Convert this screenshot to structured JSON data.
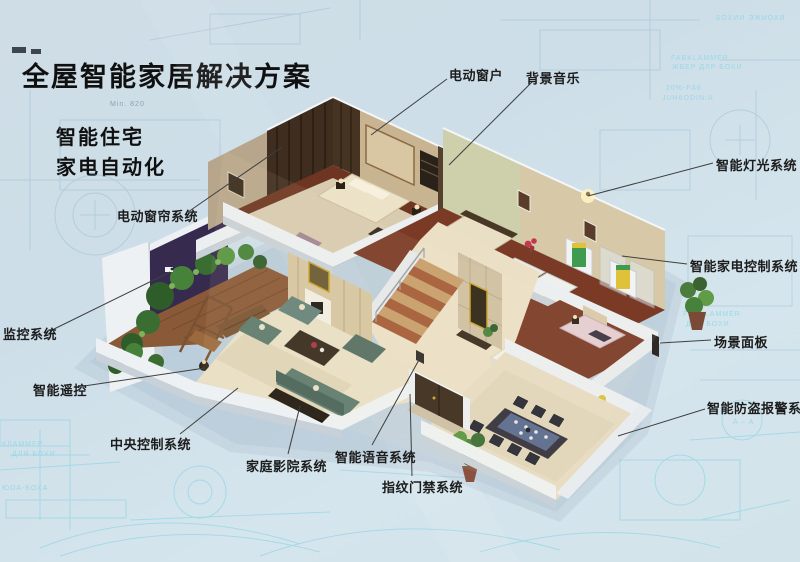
{
  "header": {
    "title": "全屋智能家居解决方案",
    "subtitle_lines": [
      "智能住宅",
      "家电自动化"
    ]
  },
  "callouts": [
    {
      "id": "electric-window",
      "label": "电动窗户"
    },
    {
      "id": "background-music",
      "label": "背景音乐"
    },
    {
      "id": "smart-lighting",
      "label": "智能灯光系统"
    },
    {
      "id": "appliance-control",
      "label": "智能家电控制系统"
    },
    {
      "id": "scene-panel",
      "label": "场景面板"
    },
    {
      "id": "burglar-alarm",
      "label": "智能防盗报警系统"
    },
    {
      "id": "electric-curtain",
      "label": "电动窗帘系统"
    },
    {
      "id": "monitoring",
      "label": "监控系统"
    },
    {
      "id": "smart-remote",
      "label": "智能遥控"
    },
    {
      "id": "central-control",
      "label": "中央控制系统"
    },
    {
      "id": "home-theater",
      "label": "家庭影院系统"
    },
    {
      "id": "smart-voice",
      "label": "智能语音系统"
    },
    {
      "id": "fingerprint-access",
      "label": "指纹门禁系统"
    }
  ],
  "background": {
    "annotations": [
      {
        "text": "Min. 820"
      },
      {
        "text": "БОХИИ ЭЖИОХИ"
      },
      {
        "text": "FABKLAMMER"
      },
      {
        "text": "ЖБЕР ДЛР БОХИ"
      },
      {
        "text": "20%-FA6"
      },
      {
        "text": "JUH6ODIN:A"
      },
      {
        "text": "FABKLAMMER"
      },
      {
        "text": "ДЛЯ БОХИ"
      },
      {
        "text": "A – A"
      },
      {
        "text": "КЛАММЕР"
      },
      {
        "text": "ДЛЯ БОХИ"
      },
      {
        "text": "ЮОА-БОХА"
      }
    ]
  },
  "colors": {
    "background": "#cfdfe8",
    "blueprint_line_bright": "#8fd4e4",
    "blueprint_line_faint": "#8fb8cc",
    "label_text": "#1c1c1c",
    "leader_line": "#3f3f3f",
    "wall_white": "#eceff1",
    "wood_floor": "#7a3a26",
    "marble_floor": "#e9dfc6",
    "sofa_teal": "#5d7a6e",
    "plant_green": "#47823a",
    "accent_purple": "#362b4e"
  }
}
